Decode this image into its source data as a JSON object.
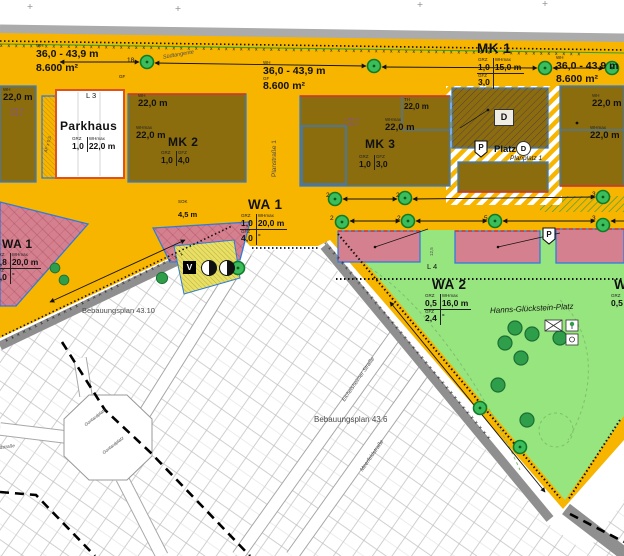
{
  "map": {
    "zones": {
      "mk1": {
        "name": "MK 1",
        "grz": "1,0",
        "whmax": "15,0 m",
        "gfz": "3,0",
        "col2r2": ""
      },
      "mk2": {
        "name": "MK 2",
        "grz": "1,0",
        "gfz": "4,0"
      },
      "mk3": {
        "name": "MK 3",
        "grz": "1,0",
        "gfz": "3,0"
      },
      "wa1_left": {
        "name": "WA 1",
        "grz": "0,8",
        "whmax": "20,0 m",
        "gfz": "2,0",
        "col2r2": "-"
      },
      "wa1": {
        "name": "WA 1",
        "grz": "1,0",
        "whmax": "20,0 m",
        "gfz": "4,0",
        "col2r2": "-"
      },
      "wa2": {
        "name": "WA 2",
        "grz": "0,5",
        "whmax": "16,0 m",
        "gfz": "2,4",
        "col2r2": "-"
      },
      "wa2_right": {
        "name": "WA 2",
        "grz": "0,5",
        "gfz": "2,4"
      },
      "parkhaus": {
        "name": "Parkhaus",
        "grz": "1,0",
        "whmax": "22,0 m"
      }
    },
    "dims": {
      "wh": "WH",
      "whmax": "WHmax",
      "grz": "GRZ",
      "gfz": "GFZ",
      "gf": "GF",
      "th": "TH",
      "sok": "SOK",
      "lpb_vi": "LPB VI",
      "lpb_v": "LPB V",
      "wh_range": "36,0 - 43,9 m",
      "gf_area": "8.600 m²",
      "h22": "22,0 m",
      "sok_val": "4,5 m",
      "af": "AF x 0,5",
      "d125": "12,5"
    },
    "streets": {
      "suedtangente": "Südtangente",
      "planstrasse": "Planstraße 1",
      "planplatz": "Planplatz 1",
      "eichelsheimer": "Eichelsheimer Straße",
      "meerfeld": "Meerfeldstraße",
      "gontardstr": "Gontardstraße",
      "gontardplatz": "Gontardplatz"
    },
    "places": {
      "platz": "Platz",
      "hanns": "Hanns-Glückstein-Platz",
      "bp4310": "Bebauungsplan 43.10",
      "bp436": "Bebauungsplan 43.6"
    },
    "marks": {
      "l3": "L 3",
      "l4": "L 4",
      "d": "D",
      "p": "P",
      "v": "V"
    },
    "tree_counts": {
      "n18": "18",
      "n2": "2",
      "n5": "5",
      "n3": "3"
    },
    "colors": {
      "plan_orange": "#F7B500",
      "block_olive": "#8C6D0E",
      "residential_green": "#97E57E",
      "parcel_red": "#D5808E",
      "tree_green": "#3CBD5C",
      "road_gray": "#8F8F8F",
      "border_blue": "#2E7DDF",
      "line_red": "#E03123",
      "boundary_purple": "#8A4FA0"
    }
  }
}
